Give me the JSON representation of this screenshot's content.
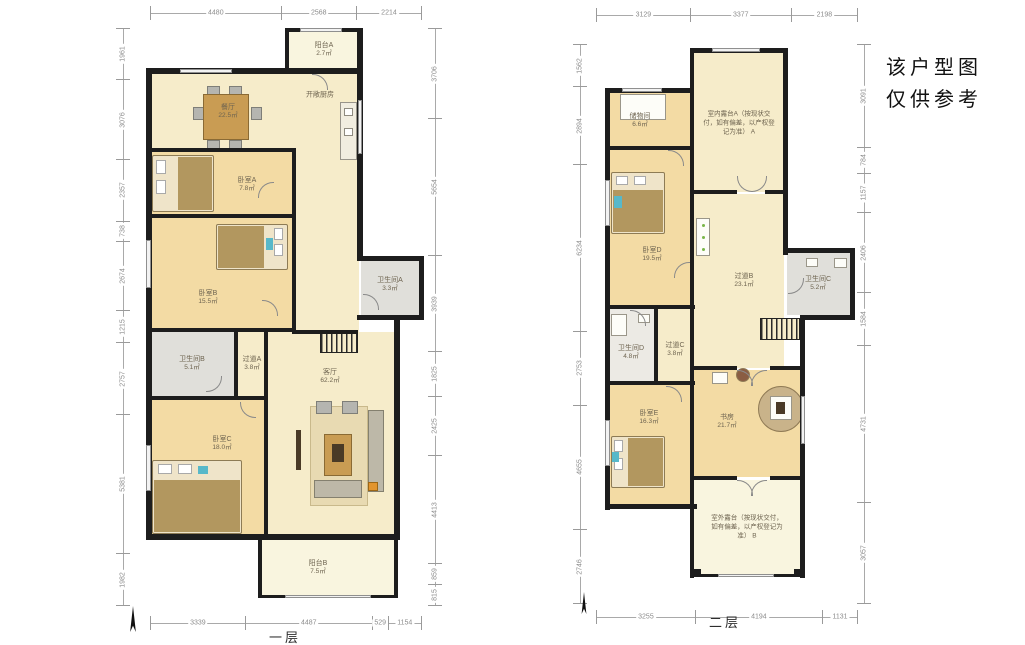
{
  "note": {
    "line1": "该户型图",
    "line2": "仅供参考"
  },
  "palette": {
    "wall": "#1d1d1d",
    "floor_cream": "#f6ecca",
    "floor_wood": "#f3dba4",
    "floor_balcony": "#f9f5df",
    "floor_bath": "#e0dfda",
    "dim_text": "#8c8c8c"
  },
  "floor1": {
    "caption": "一层",
    "rooms": {
      "balcony_a": {
        "name": "阳台A",
        "area": "2.7㎡"
      },
      "kitchen": {
        "name": "开敞厨房",
        "area": ""
      },
      "dining": {
        "name": "餐厅",
        "area": "22.5㎡"
      },
      "bedroom_a": {
        "name": "卧室A",
        "area": "7.8㎡"
      },
      "bedroom_b": {
        "name": "卧室B",
        "area": "15.5㎡"
      },
      "bath_a": {
        "name": "卫生间A",
        "area": "3.3㎡"
      },
      "bath_b": {
        "name": "卫生间B",
        "area": "5.1㎡"
      },
      "hall_a": {
        "name": "过道A",
        "area": "3.8㎡"
      },
      "living": {
        "name": "客厅",
        "area": "62.2㎡"
      },
      "bedroom_c": {
        "name": "卧室C",
        "area": "18.0㎡"
      },
      "balcony_b": {
        "name": "阳台B",
        "area": "7.5㎡"
      }
    },
    "dims": {
      "top": [
        "4480",
        "2568",
        "2214"
      ],
      "bottom": [
        "3339",
        "4487",
        "529",
        "1154"
      ],
      "left": [
        "1961",
        "3076",
        "2357",
        "738",
        "2674",
        "1215",
        "2757",
        "5381",
        "1982"
      ],
      "right": [
        "3706",
        "5654",
        "3939",
        "1825",
        "2425",
        "4413",
        "859",
        "815"
      ]
    }
  },
  "floor2": {
    "caption": "二层",
    "rooms": {
      "storage": {
        "name": "储物间",
        "area": "6.6㎡"
      },
      "terrace_a": {
        "text": "室内露台A（按现状交付，如有偏差，以产权登记为准） A"
      },
      "bedroom_d": {
        "name": "卧室D",
        "area": "19.5㎡"
      },
      "hall_b": {
        "name": "过道B",
        "area": "23.1㎡"
      },
      "bath_c": {
        "name": "卫生间C",
        "area": "5.2㎡"
      },
      "bath_d": {
        "name": "卫生间D",
        "area": "4.8㎡"
      },
      "hall_c": {
        "name": "过道C",
        "area": "3.8㎡"
      },
      "bedroom_e": {
        "name": "卧室E",
        "area": "16.3㎡"
      },
      "study": {
        "name": "书房",
        "area": "21.7㎡"
      },
      "terrace_b": {
        "text": "室外露台（按现状交付，如有偏差，以产权登记为准） B"
      }
    },
    "dims": {
      "top": [
        "3129",
        "3377",
        "2198"
      ],
      "bottom": [
        "3255",
        "4194",
        "1131"
      ],
      "left": [
        "1562",
        "2894",
        "6234",
        "2753",
        "4655",
        "2746"
      ],
      "right": [
        "3091",
        "784",
        "1157",
        "2406",
        "1584",
        "4731",
        "3057"
      ]
    }
  }
}
